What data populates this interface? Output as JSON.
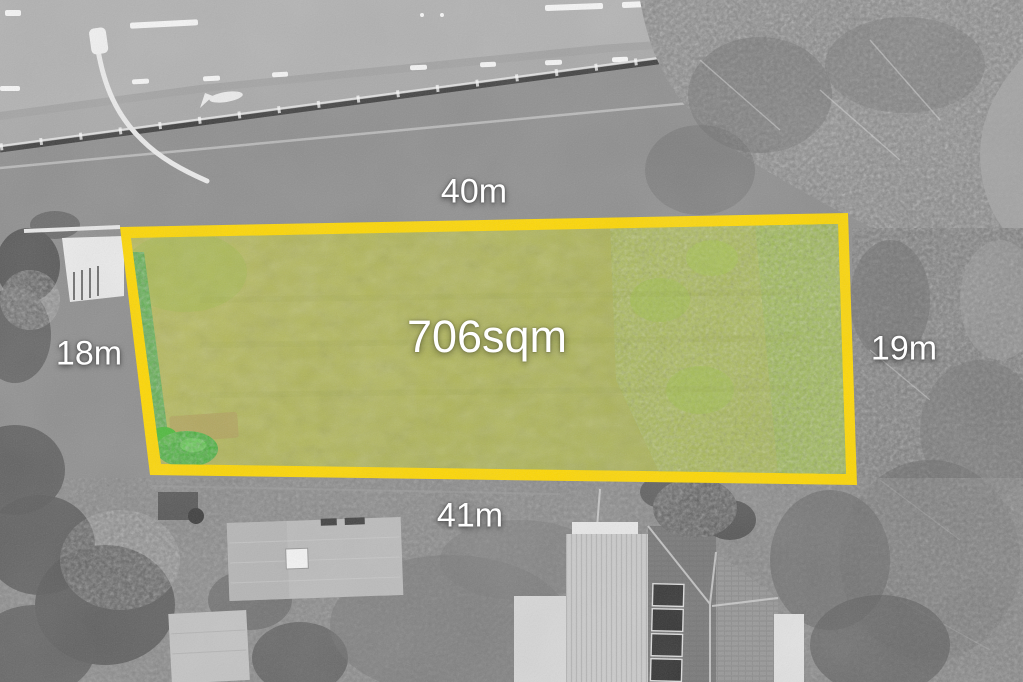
{
  "labels": {
    "top_width": "40m",
    "left_depth": "18m",
    "right_depth": "19m",
    "bottom_width": "41m",
    "area": "706sqm"
  },
  "parcel": {
    "boundary_color": "#ffd800",
    "grass_color": "#afb552",
    "hedge_green": "#4fae43",
    "foliage_green": "#9abd3f",
    "label_color": "#ffffff"
  }
}
